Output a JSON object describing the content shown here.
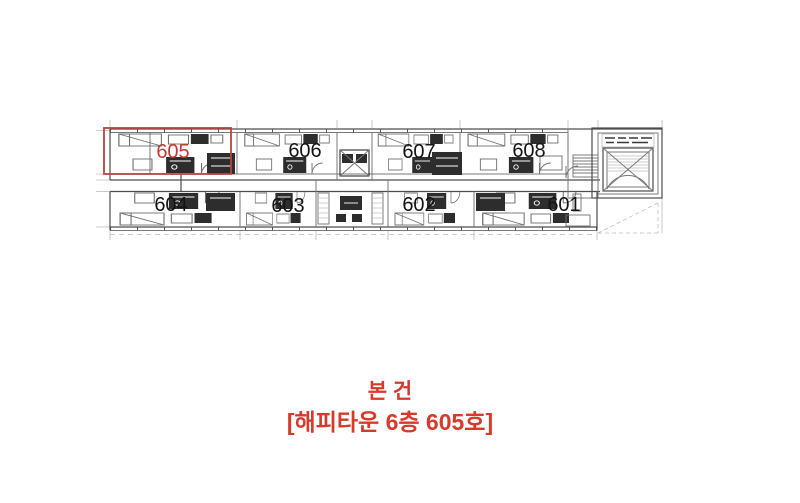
{
  "plan": {
    "units": [
      {
        "id": "605",
        "label": "605",
        "row": "top",
        "highlighted": true
      },
      {
        "id": "606",
        "label": "606",
        "row": "top",
        "highlighted": false
      },
      {
        "id": "607",
        "label": "607",
        "row": "top",
        "highlighted": false
      },
      {
        "id": "608",
        "label": "608",
        "row": "top",
        "highlighted": false
      },
      {
        "id": "604",
        "label": "604",
        "row": "bottom",
        "highlighted": false
      },
      {
        "id": "603",
        "label": "603",
        "row": "bottom",
        "highlighted": false
      },
      {
        "id": "602",
        "label": "602",
        "row": "bottom",
        "highlighted": false
      },
      {
        "id": "601",
        "label": "601",
        "row": "bottom",
        "highlighted": false
      }
    ],
    "highlight_unit": "605"
  },
  "annotation": {
    "line1": "본 건",
    "line2": "[해피타운 6층 605호]"
  },
  "colors": {
    "background": "#ffffff",
    "plan_line": "#787878",
    "plan_line_light": "#bcbcbc",
    "plan_dark": "#2d2d2d",
    "unit_label": "#141414",
    "highlight_box": "#b4453e",
    "highlight_label": "#c23a31",
    "annotation_text": "#d7392b"
  }
}
